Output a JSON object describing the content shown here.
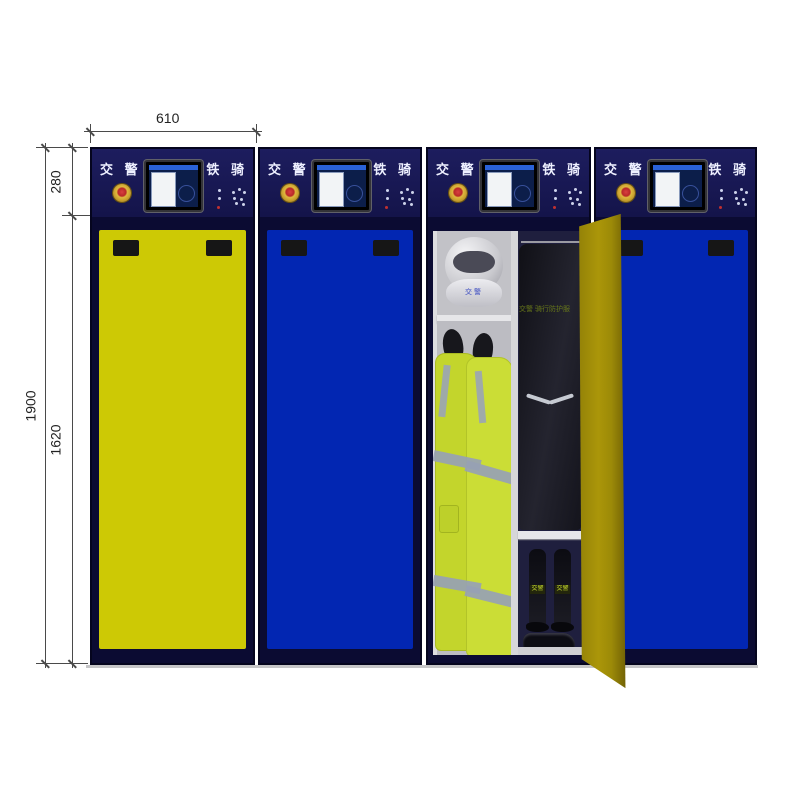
{
  "annotations": {
    "top_width": "610",
    "total_height": "1900",
    "header_height": "280",
    "body_height": "1620"
  },
  "cabinet_header": {
    "left_label": "交 警",
    "right_label": "铁 骑"
  },
  "open_cabinet": {
    "garment_label": "交警 骑行防护服",
    "helmet_label": "交警",
    "boots_label": "交警"
  },
  "cabinets": [
    {
      "name": "cabinet-1",
      "state": "closed",
      "door_color": "#cdc905"
    },
    {
      "name": "cabinet-2",
      "state": "closed",
      "door_color": "#0226b2"
    },
    {
      "name": "cabinet-3",
      "state": "open",
      "door_color": "#a28f0a"
    },
    {
      "name": "cabinet-4",
      "state": "closed",
      "door_color": "#0226b2"
    }
  ],
  "colors": {
    "frame_navy": "#0b0b32",
    "header_navy": "#18184e",
    "door_yellow": "#cdc905",
    "door_blue": "#0226b2",
    "open_door_yellow": "#a28f0a",
    "hivis_jacket": "#c6da2e",
    "reflective_stripe": "#97a1b4",
    "dimension_line": "#4a4a4a"
  }
}
